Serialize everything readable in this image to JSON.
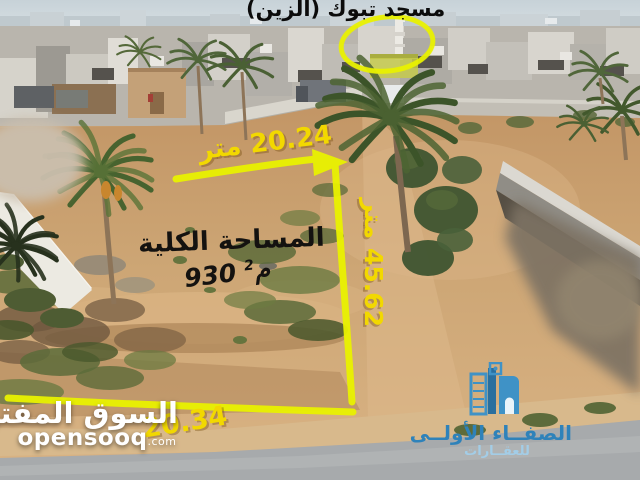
{
  "photo": {
    "mosque_label": "مسجد تبوك (الزين)",
    "dimensions": {
      "top": "20.24 متر",
      "side": "45.62 متر",
      "bottom": "20.34"
    },
    "area": {
      "title": "المساحة الكلية",
      "value_number": "930",
      "value_unit": "م",
      "value_sup": "2"
    },
    "colors": {
      "annotation_line": "#e9f200",
      "annotation_text": "#f2d800",
      "logo_blue": "#2e82ba",
      "logo_light_blue": "#a3cde7"
    }
  },
  "watermark": {
    "site_name_arabic": "السوق المفتوح",
    "site_name_latin": "opensooq",
    "domain_suffix": ".com"
  },
  "agency_logo": {
    "name": "الصفــاء الأولــى",
    "subtitle": "للعقــارات"
  }
}
